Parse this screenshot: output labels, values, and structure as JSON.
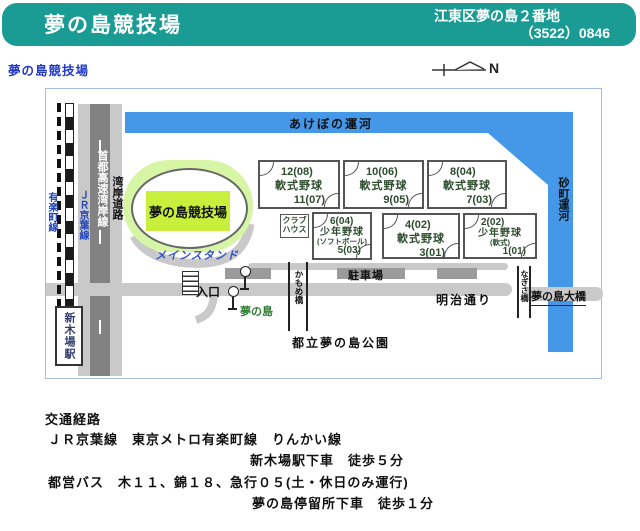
{
  "header": {
    "title": "夢の島競技場",
    "address": "江東区夢の島２番地",
    "phone": "（3522）0846"
  },
  "map": {
    "title_label": "夢の島競技場",
    "compass": "N",
    "canals": {
      "akebono": "あけぼの運河",
      "sunamachi": "砂町運河"
    },
    "roads": {
      "wangan": "湾岸道路",
      "shuto_expwy": "首都高速湾岸線",
      "meiji": "明治通り"
    },
    "railways": {
      "yurakucho": "有楽町線",
      "keiyo": "ＪＲ京葉線",
      "station": "新木場駅"
    },
    "stadium": {
      "name": "夢の島競技場",
      "main_stand": "メインスタンド"
    },
    "clubhouse": {
      "line1": "クラブ",
      "line2": "ハウス"
    },
    "fields": [
      {
        "top": "12(08)",
        "mid": "軟式野球",
        "bottom": "11(07)"
      },
      {
        "top": "10(06)",
        "mid": "軟式野球",
        "bottom": "9(05)"
      },
      {
        "top": "8(04)",
        "mid": "軟式野球",
        "bottom": "7(03)"
      },
      {
        "top": "6(04)",
        "mid": "少年野球",
        "sub": "(ソフトボール)",
        "bottom": "5(03)"
      },
      {
        "top": "4(02)",
        "mid": "軟式野球",
        "bottom": "3(01)"
      },
      {
        "top": "2(02)",
        "mid": "少年野球",
        "sub": "(軟式)",
        "bottom": "1(01)"
      }
    ],
    "labels": {
      "entrance": "入口",
      "bus_stop": "夢の島",
      "parking": "駐車場",
      "park": "都立夢の島公園",
      "kamome_bridge": "かもめ橋",
      "nagisa_bridge": "なぎさ橋",
      "ohashi_bridge": "夢の島大橋"
    }
  },
  "access": {
    "heading": "交通経路",
    "line1": "ＪＲ京葉線　東京メトロ有楽町線　りんかい線",
    "line2": "新木場駅下車　徒歩５分",
    "line3": "都営バス　木１１、錦１８、急行０５(土・休日のみ運行)",
    "line4": "夢の島停留所下車　徒歩１分"
  },
  "colors": {
    "header_bg": "#1a9c94",
    "canal_blue": "#4597e8",
    "stadium_fill": "#c7ef3b",
    "stadium_halo": "#d6f6a6",
    "road_gray": "#c9c9c9",
    "expressway_gray": "#828282",
    "field_text_green": "#2c4c2c",
    "busstop_green": "#2e7d32",
    "label_blue": "#2238c8"
  }
}
